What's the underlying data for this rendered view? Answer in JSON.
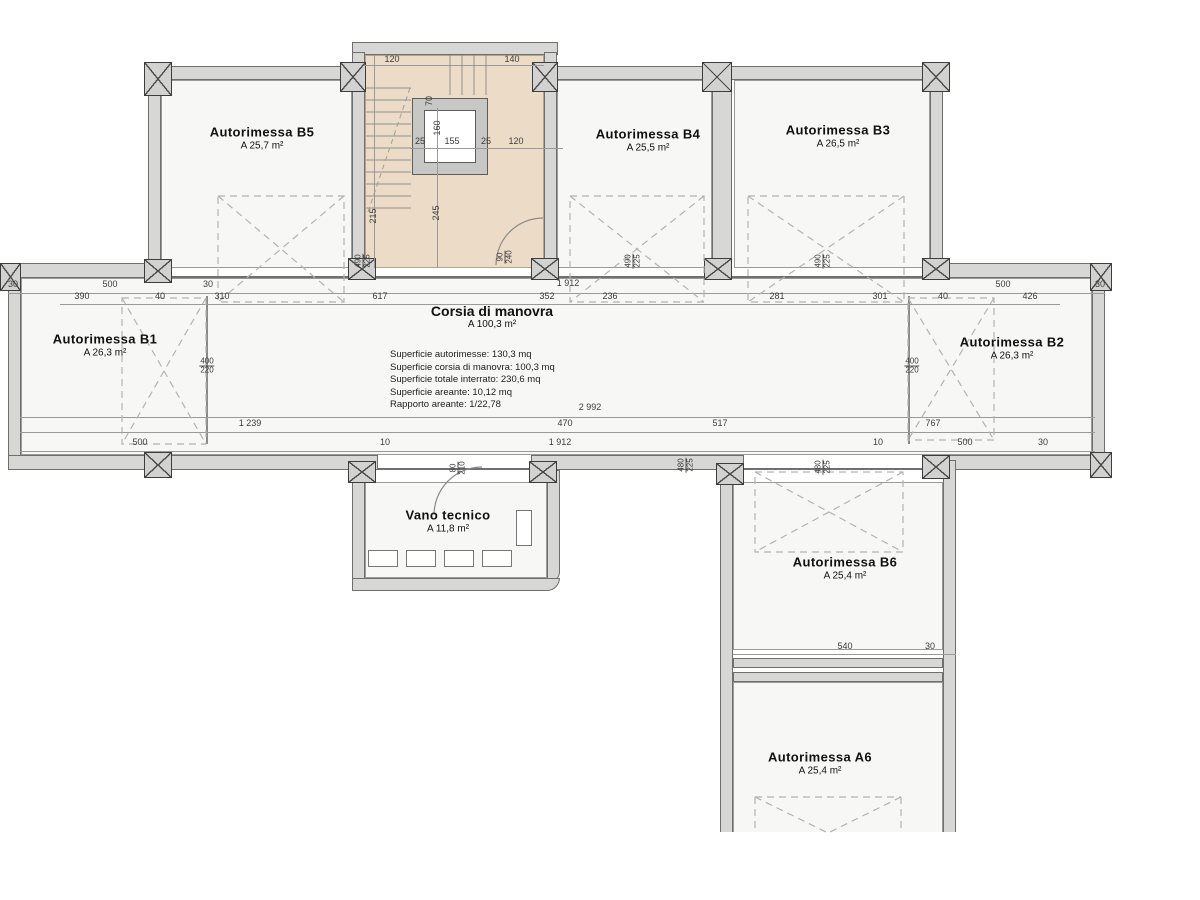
{
  "plan_title": "Interrato - Autorimesse (floor plan)",
  "rooms": [
    {
      "id": "b5",
      "name": "Autorimessa B5",
      "area": "A 25,7 m²",
      "x": 262,
      "y": 138
    },
    {
      "id": "b4",
      "name": "Autorimessa B4",
      "area": "A 25,5 m²",
      "x": 648,
      "y": 140
    },
    {
      "id": "b3",
      "name": "Autorimessa B3",
      "area": "A 26,5 m²",
      "x": 838,
      "y": 136
    },
    {
      "id": "b1",
      "name": "Autorimessa B1",
      "area": "A 26,3 m²",
      "x": 105,
      "y": 345
    },
    {
      "id": "b2",
      "name": "Autorimessa B2",
      "area": "A 26,3 m²",
      "x": 1012,
      "y": 348
    },
    {
      "id": "vano",
      "name": "Vano tecnico",
      "area": "A 11,8 m²",
      "x": 448,
      "y": 521
    },
    {
      "id": "b6",
      "name": "Autorimessa B6",
      "area": "A 25,4 m²",
      "x": 845,
      "y": 568
    },
    {
      "id": "a6",
      "name": "Autorimessa A6",
      "area": "A 25,4 m²",
      "x": 820,
      "y": 763
    }
  ],
  "corridor": {
    "name": "Corsia di manovra",
    "area": "A 100,3 m²",
    "x": 492,
    "y": 303,
    "info_x": 390,
    "info_y": 349,
    "info_lines": [
      "Superficie autorimesse: 130,3 mq",
      "Superficie corsia di manovra: 100,3 mq",
      "Superficie totale interrato: 230,6 mq",
      "Superficie areante: 10,12 mq",
      "Rapporto areante: 1/22,78"
    ]
  },
  "dimensions": [
    {
      "v": "30",
      "x": 13,
      "y": 284
    },
    {
      "v": "500",
      "x": 110,
      "y": 284
    },
    {
      "v": "30",
      "x": 208,
      "y": 284
    },
    {
      "v": "1 912",
      "x": 568,
      "y": 283
    },
    {
      "v": "500",
      "x": 1003,
      "y": 284
    },
    {
      "v": "30",
      "x": 1100,
      "y": 284
    },
    {
      "v": "390",
      "x": 82,
      "y": 296
    },
    {
      "v": "40",
      "x": 160,
      "y": 296
    },
    {
      "v": "310",
      "x": 222,
      "y": 296
    },
    {
      "v": "617",
      "x": 380,
      "y": 296
    },
    {
      "v": "352",
      "x": 547,
      "y": 296
    },
    {
      "v": "236",
      "x": 610,
      "y": 296
    },
    {
      "v": "281",
      "x": 777,
      "y": 296
    },
    {
      "v": "301",
      "x": 880,
      "y": 296
    },
    {
      "v": "40",
      "x": 943,
      "y": 296
    },
    {
      "v": "426",
      "x": 1030,
      "y": 296
    },
    {
      "v": "2 992",
      "x": 590,
      "y": 407
    },
    {
      "v": "1 239",
      "x": 250,
      "y": 423
    },
    {
      "v": "470",
      "x": 565,
      "y": 423
    },
    {
      "v": "517",
      "x": 720,
      "y": 423
    },
    {
      "v": "767",
      "x": 933,
      "y": 423
    },
    {
      "v": "500",
      "x": 140,
      "y": 442
    },
    {
      "v": "10",
      "x": 385,
      "y": 442
    },
    {
      "v": "1 912",
      "x": 560,
      "y": 442
    },
    {
      "v": "10",
      "x": 878,
      "y": 442
    },
    {
      "v": "500",
      "x": 965,
      "y": 442
    },
    {
      "v": "30",
      "x": 1043,
      "y": 442
    },
    {
      "v": "540",
      "x": 845,
      "y": 646
    },
    {
      "v": "30",
      "x": 930,
      "y": 646
    },
    {
      "v": "120",
      "x": 392,
      "y": 59
    },
    {
      "v": "140",
      "x": 512,
      "y": 59
    },
    {
      "v": "25",
      "x": 420,
      "y": 141
    },
    {
      "v": "155",
      "x": 452,
      "y": 141
    },
    {
      "v": "25",
      "x": 486,
      "y": 141
    },
    {
      "v": "120",
      "x": 516,
      "y": 141
    },
    {
      "v": "160",
      "x": 437,
      "y": 128,
      "rot": 90
    },
    {
      "v": "245",
      "x": 436,
      "y": 213,
      "rot": 90
    },
    {
      "v": "215",
      "x": 373,
      "y": 216,
      "rot": 90
    },
    {
      "v": "70",
      "x": 429,
      "y": 101,
      "rot": 90
    }
  ],
  "fraction_dimensions": [
    {
      "top": "400",
      "bottom": "220",
      "x": 207,
      "y": 366
    },
    {
      "top": "400",
      "bottom": "220",
      "x": 912,
      "y": 366
    }
  ],
  "stacked_dimensions": [
    {
      "top": "490",
      "bottom": "225",
      "x": 363,
      "y": 261
    },
    {
      "top": "490",
      "bottom": "225",
      "x": 633,
      "y": 261
    },
    {
      "top": "490",
      "bottom": "225",
      "x": 823,
      "y": 261
    },
    {
      "top": "90",
      "bottom": "240",
      "x": 505,
      "y": 257
    },
    {
      "top": "80",
      "bottom": "210",
      "x": 458,
      "y": 468
    },
    {
      "top": "480",
      "bottom": "225",
      "x": 686,
      "y": 465
    },
    {
      "top": "480",
      "bottom": "225",
      "x": 823,
      "y": 467
    }
  ],
  "colors": {
    "wall_fill": "#d7d7d6",
    "wall_border": "#6f6f6e",
    "floor": "#f7f7f6",
    "stairwell_fill": "#ecdcc7",
    "dashed_marker": "#b3b3b3",
    "dimension_text": "#3c3c3c"
  }
}
